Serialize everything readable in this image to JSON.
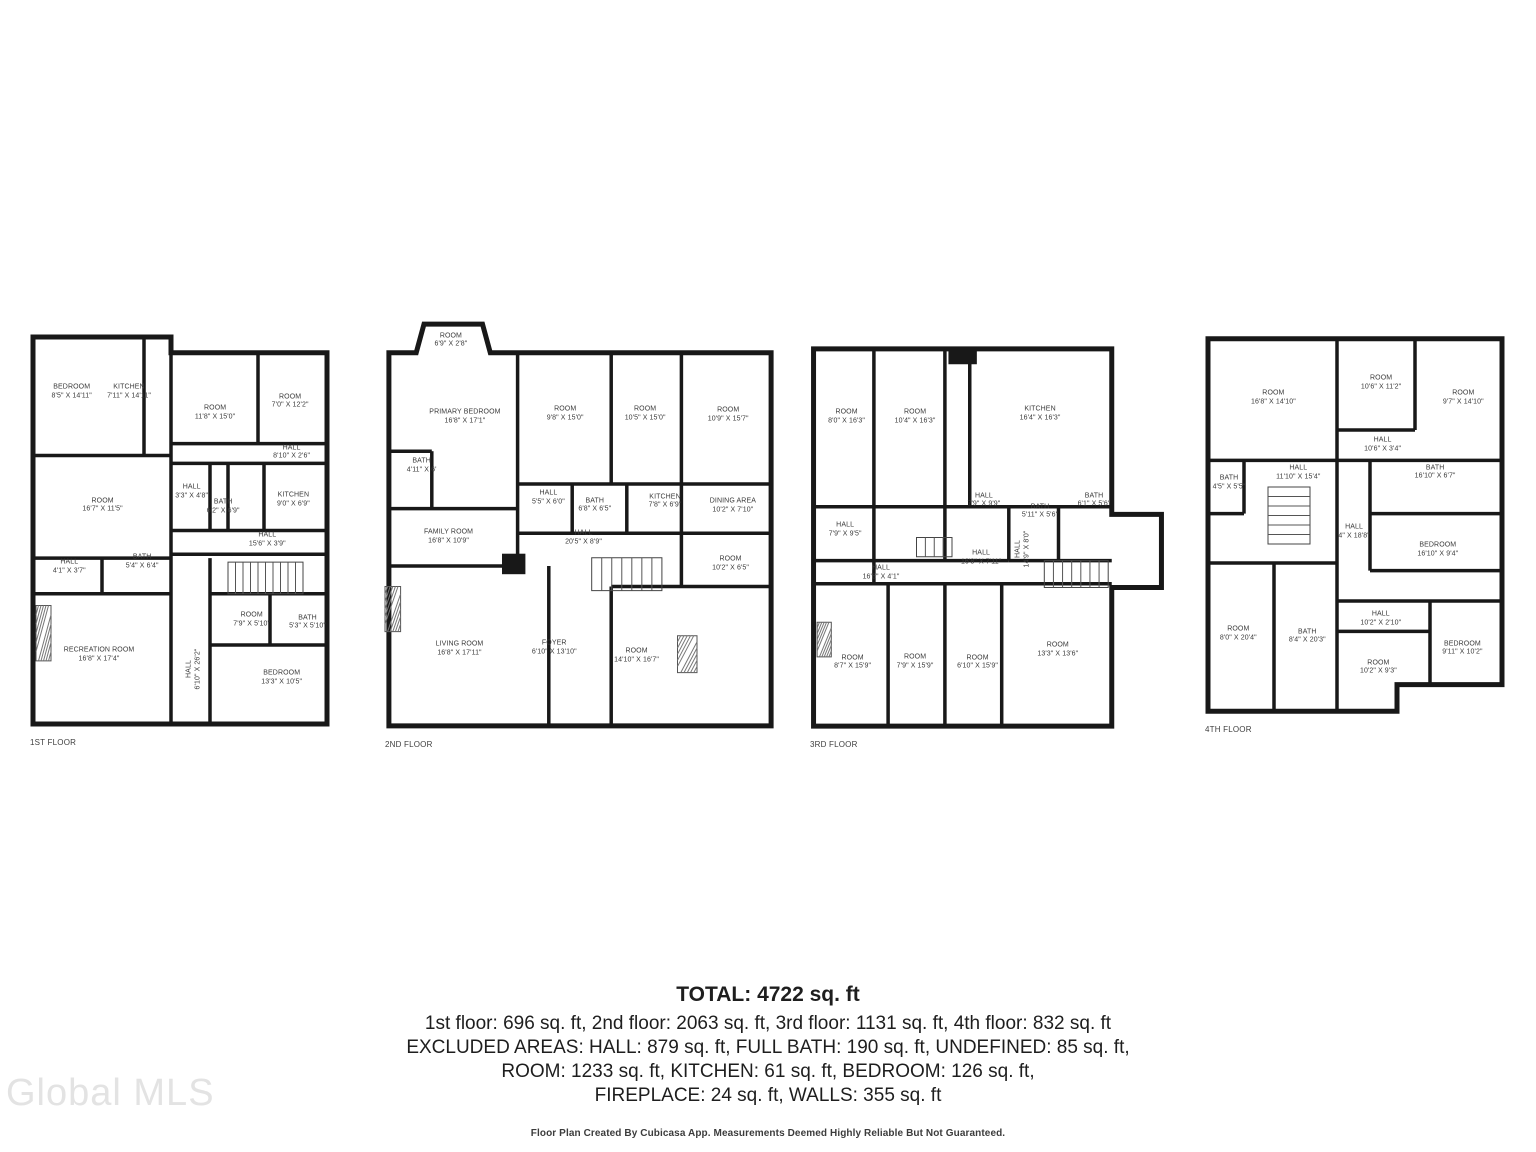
{
  "watermark": "Global MLS",
  "colors": {
    "wall": "#181818",
    "label": "#3a3a3a",
    "watermark": "#e3e3e3"
  },
  "summary": {
    "total": "TOTAL: 4722 sq. ft",
    "floor_totals": "1st floor: 696 sq. ft, 2nd floor: 2063 sq. ft, 3rd floor: 1131 sq. ft, 4th floor: 832 sq. ft",
    "excluded_line_1": "EXCLUDED AREAS: HALL: 879 sq. ft, FULL BATH: 190 sq. ft, UNDEFINED: 85 sq. ft,",
    "excluded_line_2": "ROOM: 1233 sq. ft, KITCHEN: 61 sq. ft, BEDROOM: 126 sq. ft,",
    "excluded_line_3": "FIREPLACE: 24 sq. ft, WALLS: 355 sq. ft",
    "disclaimer": "Floor Plan Created By Cubicasa App. Measurements Deemed Highly Reliable But Not Guaranteed."
  },
  "floors": [
    {
      "label": "1ST FLOOR",
      "rooms": [
        {
          "name": "BEDROOM",
          "dims": "8'5\" X 14'11\""
        },
        {
          "name": "KITCHEN",
          "dims": "7'11\" X 14'11\""
        },
        {
          "name": "ROOM",
          "dims": "11'8\" X 15'0\""
        },
        {
          "name": "ROOM",
          "dims": "7'0\" X 12'2\""
        },
        {
          "name": "HALL",
          "dims": "8'10\" X 2'6\""
        },
        {
          "name": "ROOM",
          "dims": "16'7\" X 11'5\""
        },
        {
          "name": "HALL",
          "dims": "3'3\" X 4'8\""
        },
        {
          "name": "BATH",
          "dims": "6'2\" X 6'9\""
        },
        {
          "name": "KITCHEN",
          "dims": "9'0\" X 6'9\""
        },
        {
          "name": "HALL",
          "dims": "15'6\" X 3'9\""
        },
        {
          "name": "HALL",
          "dims": "4'1\" X 3'7\""
        },
        {
          "name": "BATH",
          "dims": "5'4\" X 6'4\""
        },
        {
          "name": "RECREATION ROOM",
          "dims": "16'8\" X 17'4\""
        },
        {
          "name": "HALL",
          "dims": "6'10\" X 26'2\""
        },
        {
          "name": "ROOM",
          "dims": "7'9\" X 5'10\""
        },
        {
          "name": "BATH",
          "dims": "5'3\" X 5'10\""
        },
        {
          "name": "BEDROOM",
          "dims": "13'3\" X 10'5\""
        }
      ]
    },
    {
      "label": "2ND FLOOR",
      "rooms": [
        {
          "name": "ROOM",
          "dims": "6'9\" X 2'8\""
        },
        {
          "name": "PRIMARY BEDROOM",
          "dims": "16'8\" X 17'1\""
        },
        {
          "name": "ROOM",
          "dims": "9'8\" X 15'0\""
        },
        {
          "name": "ROOM",
          "dims": "10'5\" X 15'0\""
        },
        {
          "name": "ROOM",
          "dims": "10'9\" X 15'7\""
        },
        {
          "name": "BATH",
          "dims": "4'11\" X 6'"
        },
        {
          "name": "HALL",
          "dims": "5'5\" X 6'0\""
        },
        {
          "name": "BATH",
          "dims": "6'8\" X 6'5\""
        },
        {
          "name": "KITCHEN",
          "dims": "7'8\" X 6'9\""
        },
        {
          "name": "DINING AREA",
          "dims": "10'2\" X 7'10\""
        },
        {
          "name": "ROOM",
          "dims": "10'2\" X 6'5\""
        },
        {
          "name": "FAMILY ROOM",
          "dims": "16'8\" X 10'9\""
        },
        {
          "name": "HALL",
          "dims": "20'5\" X 8'9\""
        },
        {
          "name": "LIVING ROOM",
          "dims": "16'8\" X 17'11\""
        },
        {
          "name": "FOYER",
          "dims": "6'10\" X 13'10\""
        },
        {
          "name": "ROOM",
          "dims": "14'10\" X 16'7\""
        }
      ]
    },
    {
      "label": "3RD FLOOR",
      "rooms": [
        {
          "name": "ROOM",
          "dims": "8'0\" X 16'3\""
        },
        {
          "name": "ROOM",
          "dims": "10'4\" X 16'3\""
        },
        {
          "name": "KITCHEN",
          "dims": "16'4\" X 16'3\""
        },
        {
          "name": "HALL",
          "dims": "7'9\" X 9'9\""
        },
        {
          "name": "BATH",
          "dims": "5'11\" X 5'6\""
        },
        {
          "name": "BATH",
          "dims": "6'1\" X 5'6\""
        },
        {
          "name": "HALL",
          "dims": "7'9\" X 9'5\""
        },
        {
          "name": "HALL",
          "dims": "16'8\" X 4'1\""
        },
        {
          "name": "HALL",
          "dims": "16'8\" X 7'11\""
        },
        {
          "name": "HALL",
          "dims": "14'9\" X 8'0\""
        },
        {
          "name": "ROOM",
          "dims": "8'7\" X 15'9\""
        },
        {
          "name": "ROOM",
          "dims": "7'9\" X 15'9\""
        },
        {
          "name": "ROOM",
          "dims": "6'10\" X 15'9\""
        },
        {
          "name": "ROOM",
          "dims": "13'3\" X 13'6\""
        }
      ]
    },
    {
      "label": "4TH FLOOR",
      "rooms": [
        {
          "name": "ROOM",
          "dims": "16'8\" X 14'10\""
        },
        {
          "name": "ROOM",
          "dims": "10'6\" X 11'2\""
        },
        {
          "name": "ROOM",
          "dims": "9'7\" X 14'10\""
        },
        {
          "name": "HALL",
          "dims": "10'6\" X 3'4\""
        },
        {
          "name": "BATH",
          "dims": "4'5\" X 5'5\""
        },
        {
          "name": "HALL",
          "dims": "11'10\" X 15'4\""
        },
        {
          "name": "BATH",
          "dims": "16'10\" X 6'7\""
        },
        {
          "name": "HALL",
          "dims": "4\" X 18'8\""
        },
        {
          "name": "BEDROOM",
          "dims": "16'10\" X 9'4\""
        },
        {
          "name": "ROOM",
          "dims": "8'0\" X 20'4\""
        },
        {
          "name": "BATH",
          "dims": "8'4\" X 20'3\""
        },
        {
          "name": "HALL",
          "dims": "10'2\" X 2'10\""
        },
        {
          "name": "ROOM",
          "dims": "10'2\" X 9'3\""
        },
        {
          "name": "BEDROOM",
          "dims": "9'11\" X 10'2\""
        }
      ]
    }
  ]
}
